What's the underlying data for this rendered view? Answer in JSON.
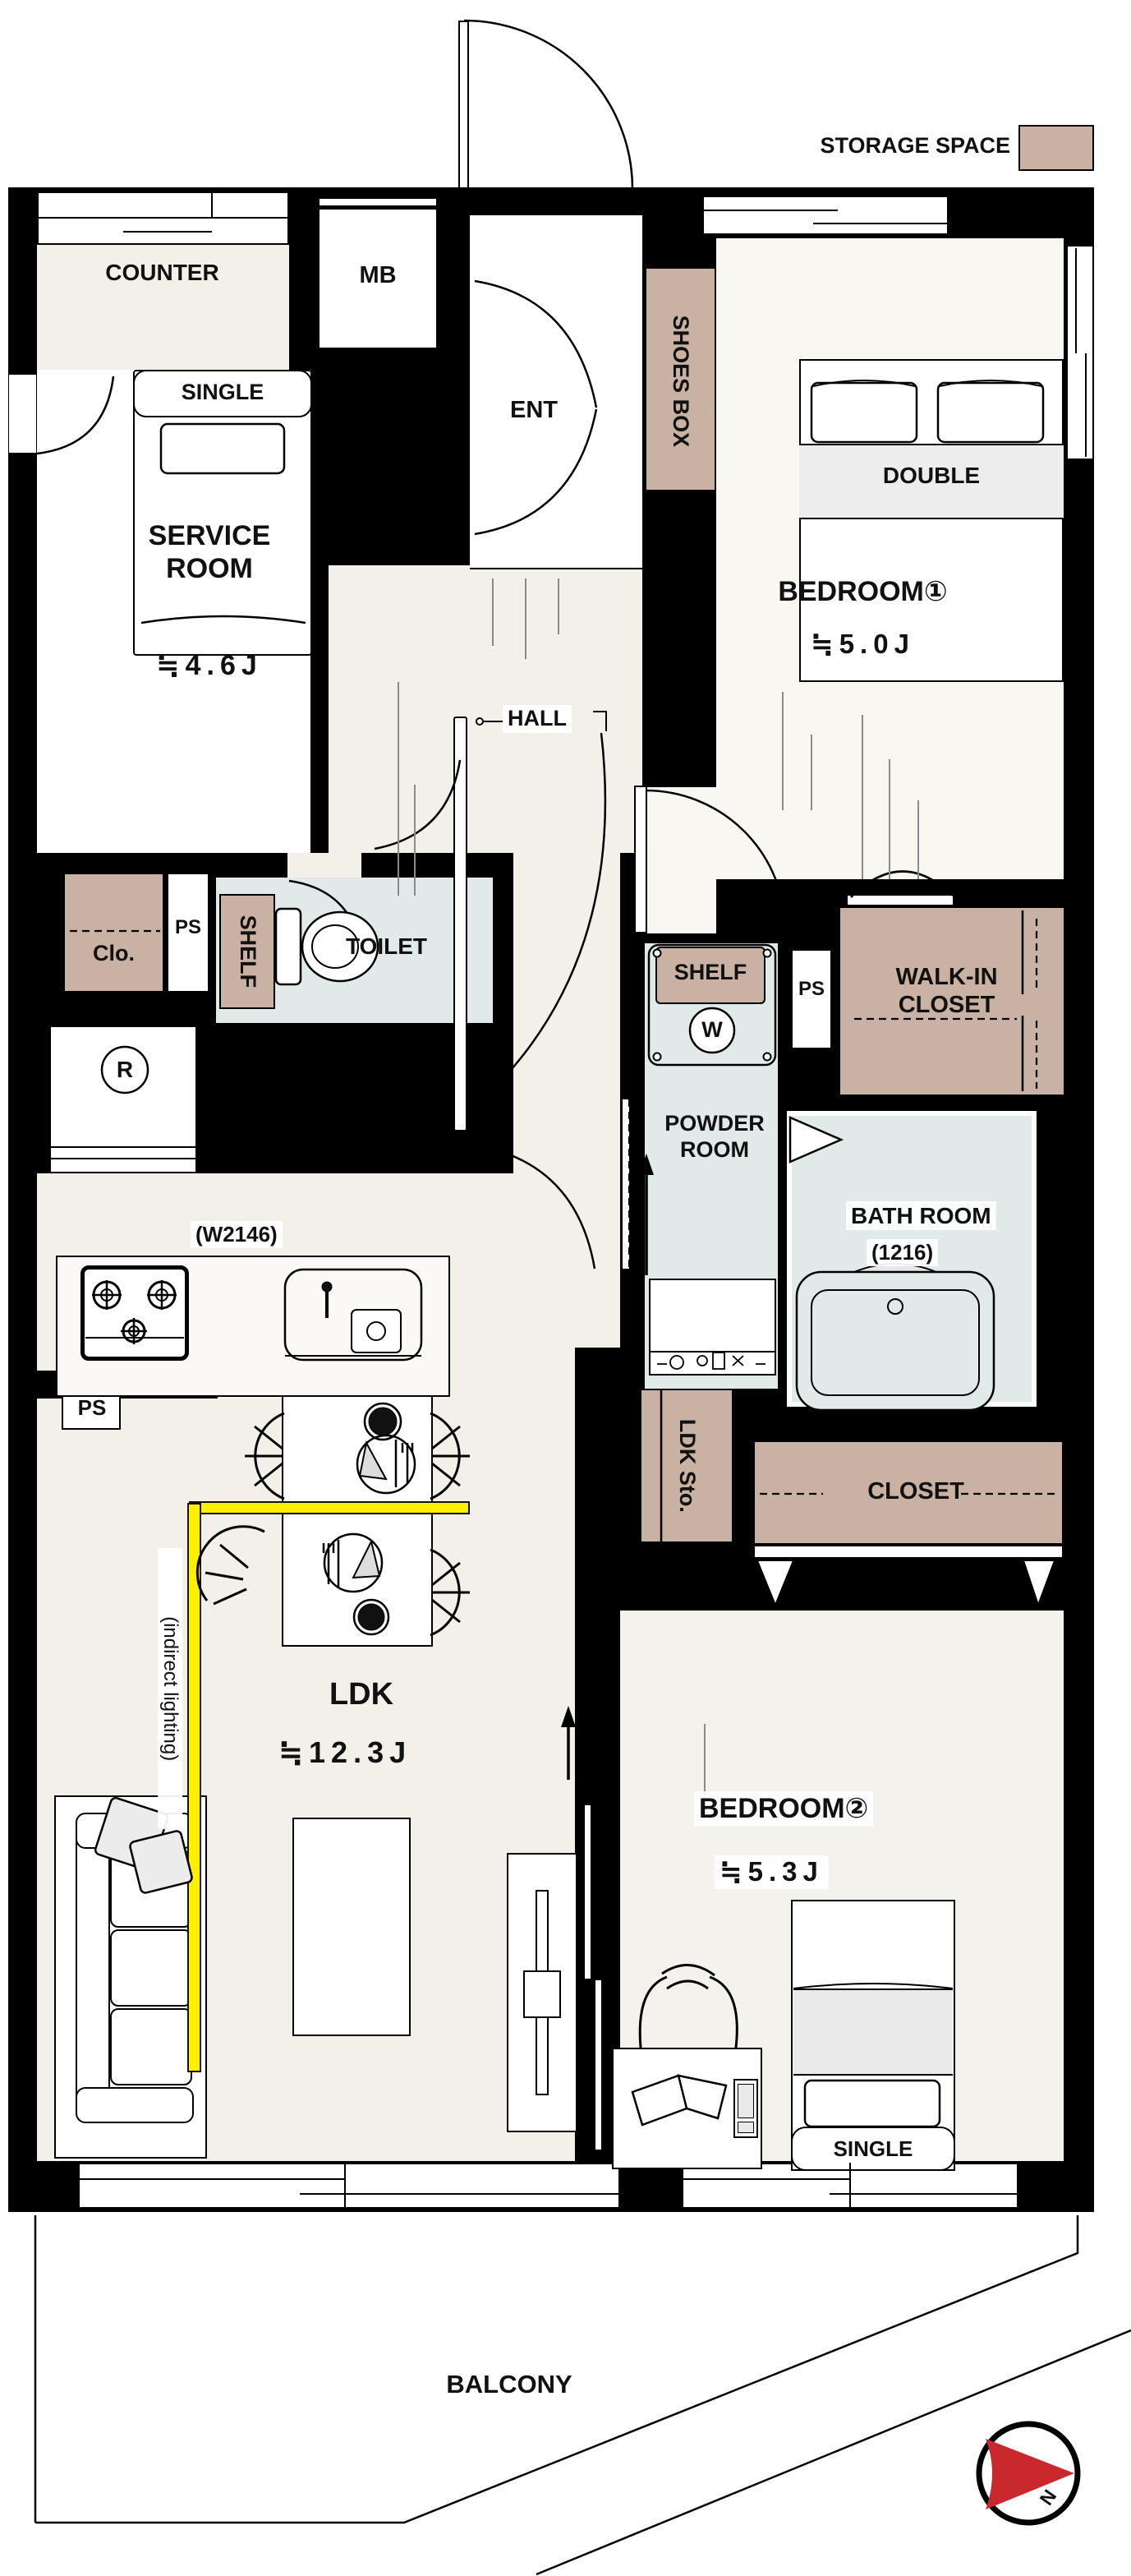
{
  "legend": {
    "label": "STORAGE SPACE"
  },
  "compass": {
    "north": "N"
  },
  "areas": {
    "counter": "COUNTER",
    "mb": "MB",
    "ent": "ENT",
    "shoes_box": "SHOES BOX",
    "service_room": {
      "name": "SERVICE ROOM",
      "size": "≒4.6J"
    },
    "bedroom1": {
      "name": "BEDROOM①",
      "size": "≒5.0J"
    },
    "hall": "HALL",
    "clo": "Clo.",
    "ps": "PS",
    "toilet": {
      "name": "TOILET",
      "shelf": "SHELF"
    },
    "fridge": "R",
    "laundry": {
      "shelf": "SHELF",
      "washer": "W"
    },
    "walk_in_closet": "WALK-IN CLOSET",
    "powder_room": "POWDER ROOM",
    "bath": {
      "name": "BATH ROOM",
      "size": "(1216)"
    },
    "kitchen": {
      "width": "(W2146)"
    },
    "ldk_sto": "LDK Sto.",
    "closet": "CLOSET",
    "ldk": {
      "name": "LDK",
      "size": "≒12.3J",
      "note": "(indirect lighting)"
    },
    "bedroom2": {
      "name": "BEDROOM②",
      "size": "≒5.3J"
    },
    "balcony": "BALCONY"
  },
  "furniture": {
    "bed_single_top": "SINGLE",
    "bed_double": "DOUBLE",
    "bed_single_bottom": "SINGLE"
  },
  "colors": {
    "wall": "#000000",
    "floor": "#f3f0e9",
    "floor_light": "#f8f7f2",
    "water": "#e1eae8",
    "storage": "#c9b2a3",
    "accent_yellow": "#ffef00",
    "compass_red": "#c9282d",
    "furniture_gray": "#e9e9e9"
  }
}
